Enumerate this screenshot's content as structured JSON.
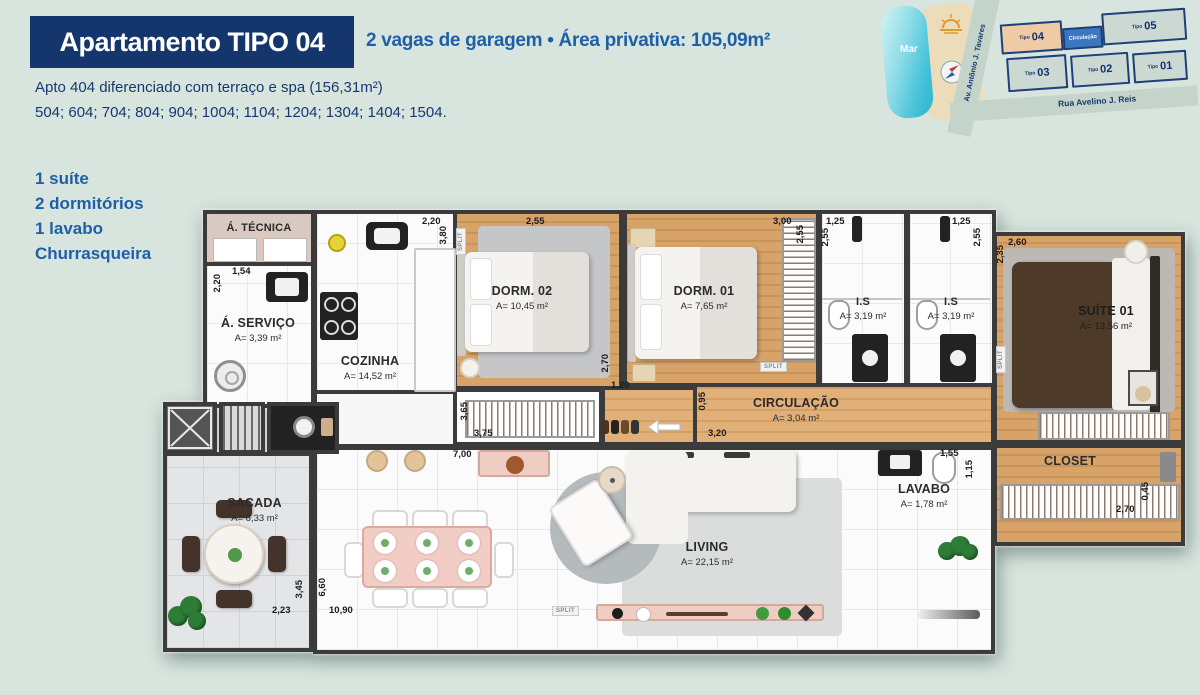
{
  "header": {
    "title": "Apartamento TIPO 04",
    "subtitle": "2 vagas de garagem • Área privativa: 105,09m²",
    "note": "Apto 404 diferenciado com terraço e spa (156,31m²)",
    "units_list": "504; 604; 704; 804; 904; 1004; 1104; 1204; 1304; 1404; 1504."
  },
  "features": [
    "1 suíte",
    "2 dormitórios",
    "1 lavabo",
    "Churrasqueira"
  ],
  "minimap": {
    "sea": "Mar",
    "avenue": "Av. Antônio J. Tavares",
    "street": "Rua Avelino J. Reis",
    "circulation": "Circulação",
    "units": [
      {
        "t": "Tipo",
        "n": "04"
      },
      {
        "t": "Tipo",
        "n": "05"
      },
      {
        "t": "Tipo",
        "n": "03"
      },
      {
        "t": "Tipo",
        "n": "02"
      },
      {
        "t": "Tipo",
        "n": "01"
      }
    ]
  },
  "plan": {
    "split": "SPLIT",
    "rooms": [
      {
        "name": "Á. TÉCNICA",
        "area": ""
      },
      {
        "name": "Á. SERVIÇO",
        "area": "A= 3,39 m²"
      },
      {
        "name": "COZINHA",
        "area": "A= 14,52 m²"
      },
      {
        "name": "DORM. 02",
        "area": "A= 10,45 m²"
      },
      {
        "name": "DORM. 01",
        "area": "A= 7,65 m²"
      },
      {
        "name": "I.S",
        "area": "A= 3,19 m²"
      },
      {
        "name": "I.S",
        "area": "A= 3,19 m²"
      },
      {
        "name": "SUÍTE 01",
        "area": "A= 13,56 m²"
      },
      {
        "name": "CIRCULAÇÃO",
        "area": "A= 3,04 m²"
      },
      {
        "name": "CLOSET",
        "area": ""
      },
      {
        "name": "LAVABO",
        "area": "A= 1,78 m²"
      },
      {
        "name": "LIVING",
        "area": "A= 22,15 m²"
      },
      {
        "name": "SACADA",
        "area": "A= 6,33 m²"
      }
    ],
    "dims": [
      "1,54",
      "2,20",
      "2,20",
      "3,80",
      "2,55",
      "2,70",
      "1,20",
      "3,65",
      "3,75",
      "7,00",
      "3,00",
      "2,55",
      "1,25",
      "2,55",
      "1,25",
      "2,55",
      "2,60",
      "2,35",
      "0,95",
      "3,20",
      "1,55",
      "1,15",
      "2,70",
      "0,45",
      "2,23",
      "3,45",
      "6,60",
      "10,90"
    ]
  }
}
